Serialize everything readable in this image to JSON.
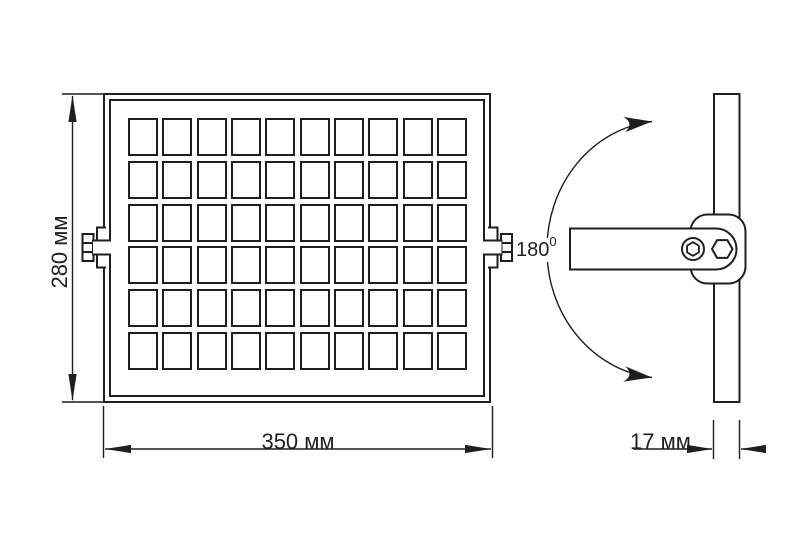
{
  "colors": {
    "ink": "#1f1f1f",
    "background": "#ffffff"
  },
  "front_view": {
    "height_dimension": "280 мм",
    "width_dimension": "350 мм",
    "cell_grid": {
      "columns": 10,
      "rows": 6
    }
  },
  "side_view": {
    "thickness_dimension": "17 мм",
    "rotation_angle": "180",
    "rotation_degree_mark": "0"
  }
}
